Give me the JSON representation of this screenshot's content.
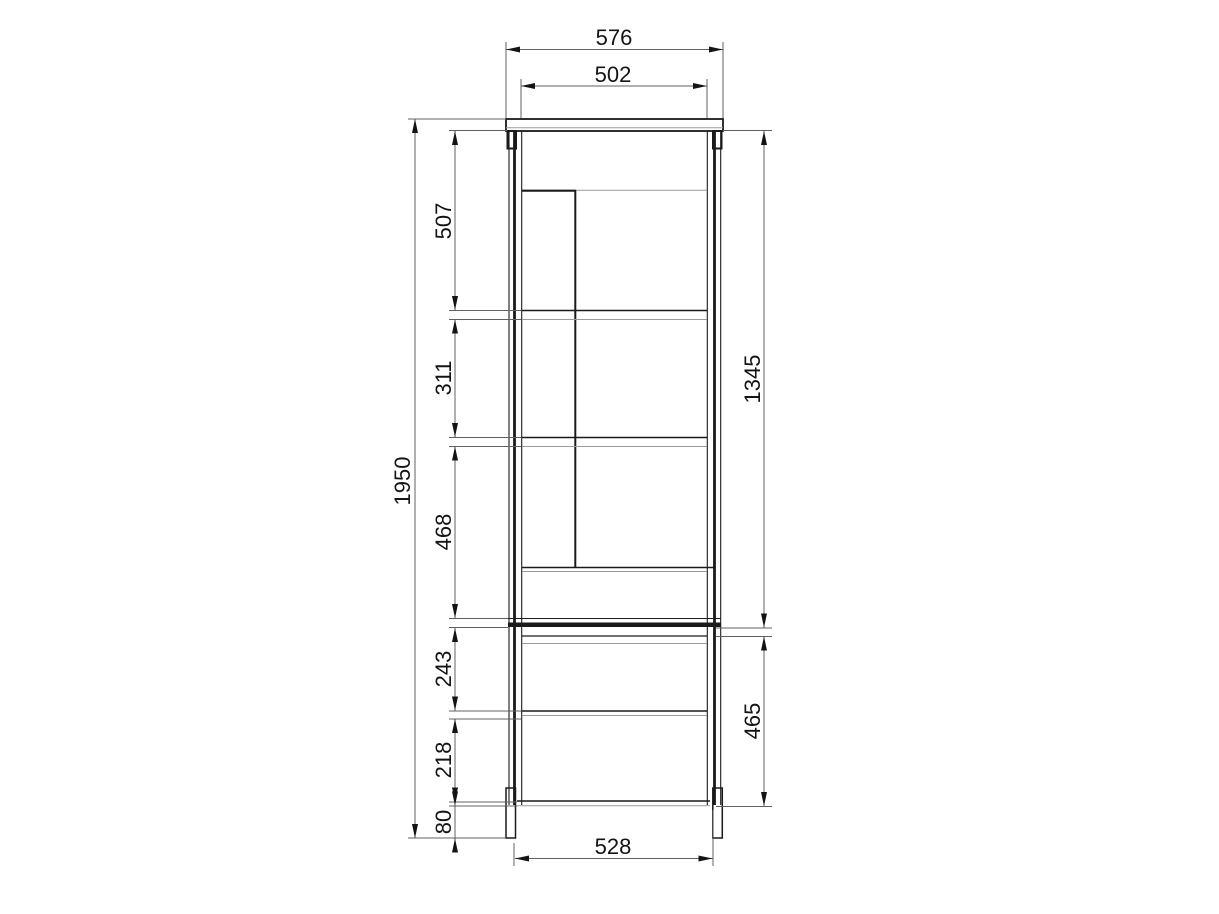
{
  "drawing": {
    "dimensions": {
      "top_width": "576",
      "inner_width": "502",
      "overall_height": "1950",
      "shelf_section_1": "507",
      "shelf_section_2": "311",
      "shelf_section_3": "468",
      "upper_unit_height": "1345",
      "drawer_section_1": "243",
      "drawer_section_2": "218",
      "plinth_height": "80",
      "lower_unit_height": "465",
      "base_width": "528"
    }
  }
}
